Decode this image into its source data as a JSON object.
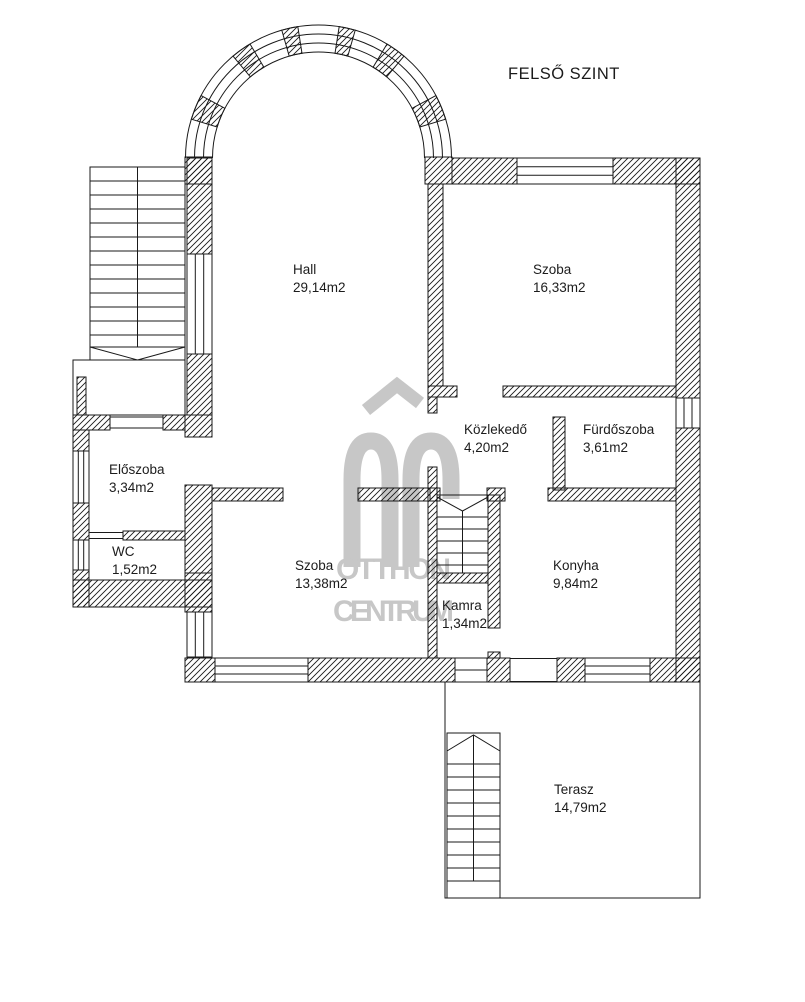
{
  "title": "FELSŐ SZINT",
  "watermark": {
    "logo": "OC",
    "line1": "OTTHON",
    "line2": "CENTRUM"
  },
  "colors": {
    "background": "#ffffff",
    "wall_line": "#1a1a1a",
    "watermark_gray": "#c7c7c7"
  },
  "rooms": [
    {
      "name": "Hall",
      "area": "29,14m2"
    },
    {
      "name": "Szoba",
      "area": "16,33m2"
    },
    {
      "name": "Közlekedő",
      "area": "4,20m2"
    },
    {
      "name": "Fürdőszoba",
      "area": "3,61m2"
    },
    {
      "name": "Előszoba",
      "area": "3,34m2"
    },
    {
      "name": "WC",
      "area": "1,52m2"
    },
    {
      "name": "Szoba",
      "area": "13,38m2"
    },
    {
      "name": "Kamra",
      "area": "1,34m2"
    },
    {
      "name": "Konyha",
      "area": "9,84m2"
    },
    {
      "name": "Terasz",
      "area": "14,79m2"
    }
  ]
}
